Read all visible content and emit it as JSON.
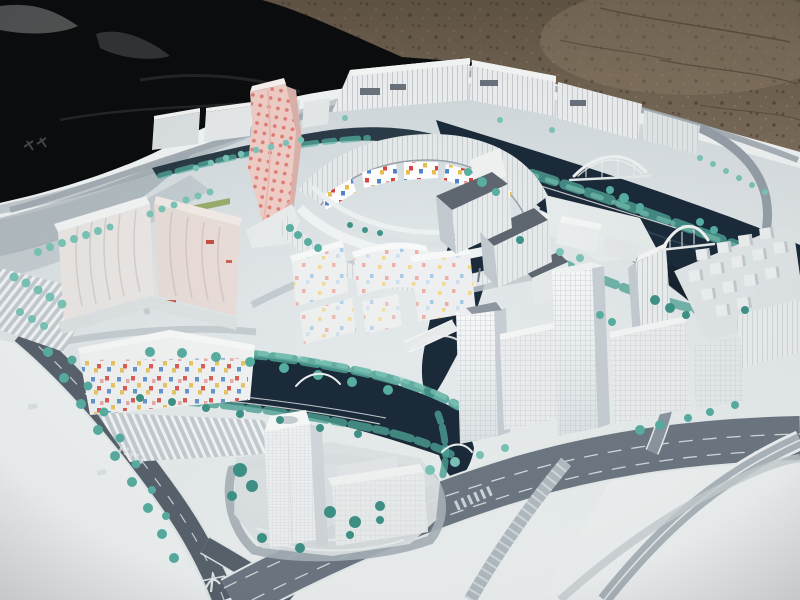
{
  "image": {
    "type": "photograph",
    "subject": "architectural scale model of a waterfront urban masterplan district",
    "setting": "model board displayed outdoors, black tarpaulin on the left, sandy gravel ground behind"
  },
  "scene": {
    "background": {
      "left": "black tarpaulin fabric",
      "right": "sandy gravel ground with cracks"
    },
    "model": {
      "base": "white presentation board with grey street network",
      "water": "dark navy canal network winding through the district",
      "vegetation": "rows of small teal model trees along streets and canal banks",
      "bridges": "white arched footbridges crossing the canals",
      "markings": {
        "board_top_left": "small dark printed marks on the board",
        "south_road": "white painted symbol on the foreground road"
      },
      "districts": [
        {
          "name": "north-sheds",
          "desc": "long ribbed low-rise halls along the north edge"
        },
        {
          "name": "pink-tower",
          "desc": "leaning pink tower with red dot facade"
        },
        {
          "name": "crescent-court",
          "desc": "crescent block ringing a court, multicolour mosaic inner facade"
        },
        {
          "name": "west-slabs",
          "desc": "large cream slab blocks with wavy ribbed facades"
        },
        {
          "name": "mosaic-lowrise",
          "desc": "low-rise blocks with scattered colour window tiles"
        },
        {
          "name": "center-slabs",
          "desc": "mid-rise slabs with dark grey roofs"
        },
        {
          "name": "east-cube-village",
          "desc": "cluster of small white cubic houses"
        },
        {
          "name": "riverfront-towers",
          "desc": "white high-rise towers with gridded facades"
        },
        {
          "name": "south-tower",
          "desc": "translucent high-rise with stepped podium on a canal island"
        }
      ]
    }
  },
  "colors": {
    "tarp": "#0b0c0e",
    "ground": "#7d6e5b",
    "ground_dark": "#5f5244",
    "board": "#e4e9eb",
    "board_bright": "#f3f6f6",
    "water": "#1b2b3a",
    "water_deep": "#141f2a",
    "tree_light": "#7cc6ba",
    "tree_mid": "#59b0a3",
    "tree_dark": "#3f9488",
    "road_dark": "#5a646e",
    "road_mid": "#6e7984",
    "road_light": "#c3cbd0",
    "building": "#eef0f1",
    "building_side": "#c6cdd3",
    "roof_dark": "#5f6771",
    "pink_tower": "#f1cfc9",
    "pink_dot": "#de7168",
    "accent_red": "#d8453c",
    "accent_yellow": "#e8c04e",
    "accent_blue": "#4f86c9",
    "grass": "#93a95e"
  }
}
